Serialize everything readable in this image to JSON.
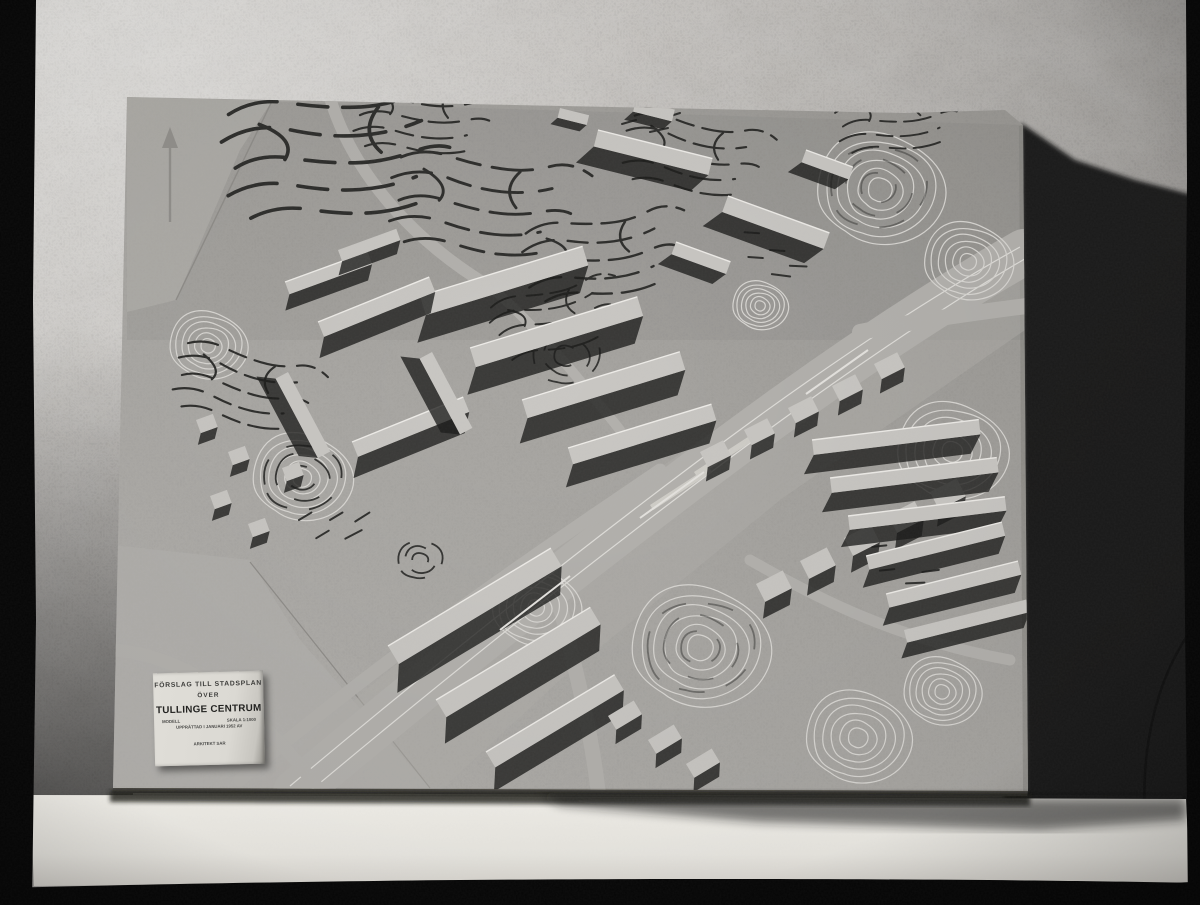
{
  "scene": {
    "description": "Black-and-white photograph of a plaster architectural relief model of a town plan, standing on a white ledge against a rough stucco wall, casting a deep shadow to the right"
  },
  "label_card": {
    "heading_line1": "FÖRSLAG TILL STADSPLAN",
    "heading_line2": "ÖVER",
    "title": "TULLINGE CENTRUM",
    "meta_model": "MODELL",
    "meta_scale": "SKALA 1:1000",
    "meta_date": "UPPRÄTTAD I JANUARI 1952 AV",
    "credit": "ARKITEKT SAR"
  },
  "palette": {
    "film_border": "#060606",
    "wall_light": "#d6d4d0",
    "wall_mid": "#aaa7a3",
    "cast_shadow": "#171717",
    "board_gray": "#a7a5a1",
    "ledge_white": "#f2f0ea",
    "card_white": "#dcdad4",
    "contour_white": "#d9d7d3",
    "contour_dark": "#2f2f2d"
  }
}
